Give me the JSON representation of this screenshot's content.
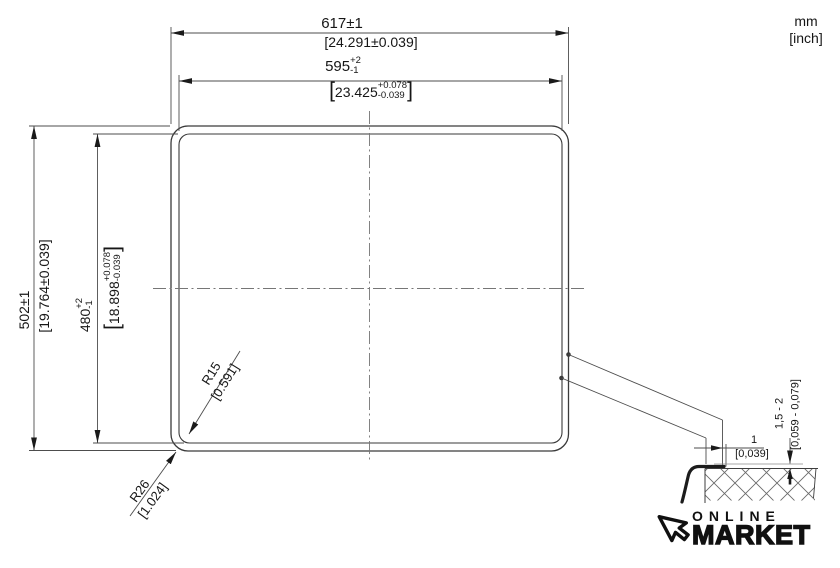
{
  "units": {
    "metric": "mm",
    "imperial": "[inch]"
  },
  "symbols": {
    "bracket_open": "[",
    "bracket_close": "]"
  },
  "dimensions": {
    "outer_width": {
      "metric": "617±1",
      "imperial": "[24.291±0.039]"
    },
    "inner_width": {
      "metric_value": "595",
      "metric_plus": "+2",
      "metric_minus": "-1",
      "imperial_value": "23.425",
      "imperial_plus": "+0.078",
      "imperial_minus": "-0.039"
    },
    "outer_height": {
      "metric": "502±1",
      "imperial": "[19.764±0.039]"
    },
    "inner_height": {
      "metric_value": "480",
      "metric_plus": "+2",
      "metric_minus": "-1",
      "imperial_value": "18.898",
      "imperial_plus": "+0.078",
      "imperial_minus": "-0.039"
    },
    "corner_radius_inner": {
      "metric": "R15",
      "imperial": "[0.591]"
    },
    "corner_radius_outer": {
      "metric": "R26",
      "imperial": "[1.024]"
    },
    "rim_gap": {
      "metric": "1",
      "imperial": "[0,039]"
    },
    "rim_height": {
      "metric": "1,5 - 2",
      "imperial": "[0,059 - 0,079]"
    }
  },
  "logo": {
    "line1": "ONLINE",
    "line2": "MARKET"
  }
}
